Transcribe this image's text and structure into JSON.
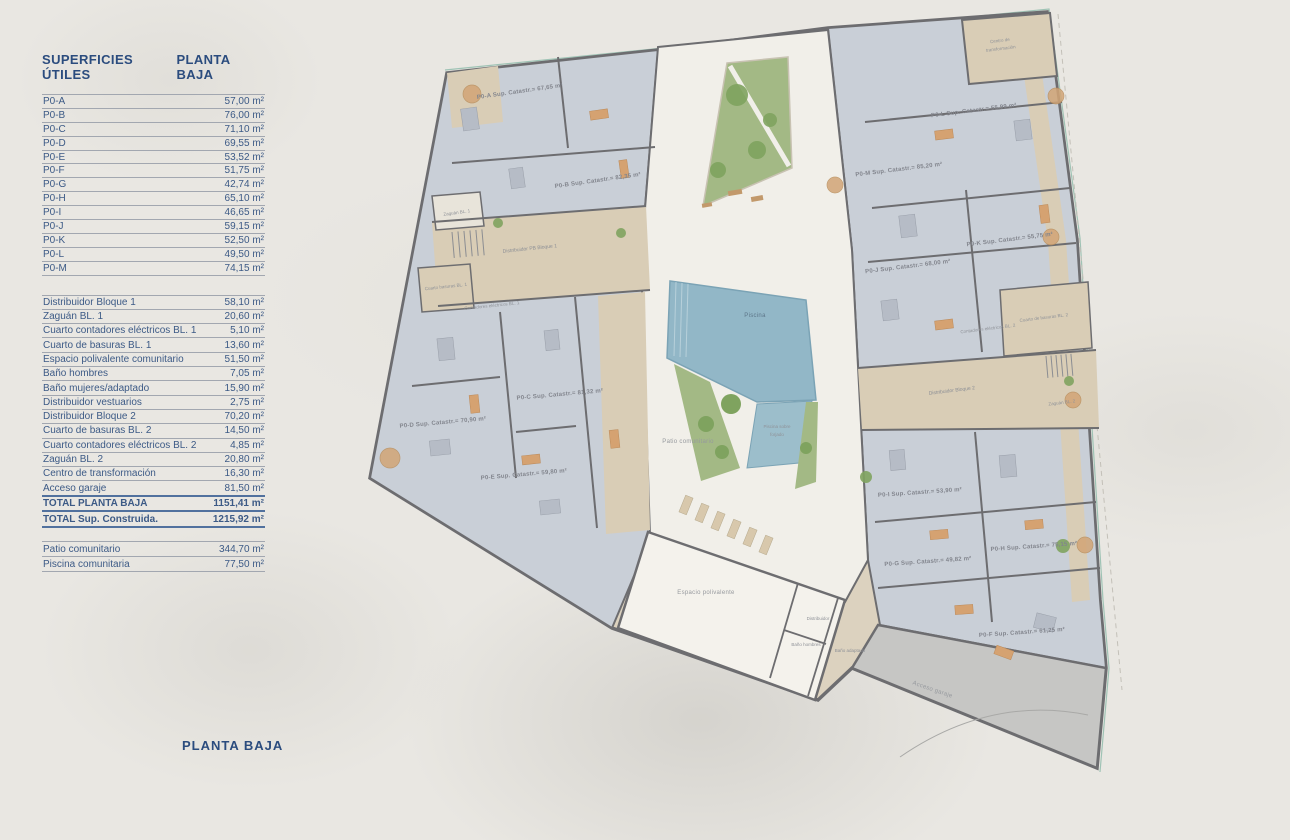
{
  "sidebar": {
    "title_left": "SUPERFICIES ÚTILES",
    "title_right": "PLANTA BAJA",
    "units": [
      {
        "label": "P0-A",
        "value": "57,00 m²"
      },
      {
        "label": "P0-B",
        "value": "76,00 m²"
      },
      {
        "label": "P0-C",
        "value": "71,10 m²"
      },
      {
        "label": "P0-D",
        "value": "69,55 m²"
      },
      {
        "label": "P0-E",
        "value": "53,52 m²"
      },
      {
        "label": "P0-F",
        "value": "51,75 m²"
      },
      {
        "label": "P0-G",
        "value": "42,74 m²"
      },
      {
        "label": "P0-H",
        "value": "65,10 m²"
      },
      {
        "label": "P0-I",
        "value": "46,65 m²"
      },
      {
        "label": "P0-J",
        "value": "59,15 m²"
      },
      {
        "label": "P0-K",
        "value": "52,50 m²"
      },
      {
        "label": "P0-L",
        "value": "49,50 m²"
      },
      {
        "label": "P0-M",
        "value": "74,15 m²"
      }
    ],
    "rooms": [
      {
        "label": "Distribuidor Bloque 1",
        "value": "58,10 m²"
      },
      {
        "label": "Zaguán BL. 1",
        "value": "20,60 m²"
      },
      {
        "label": "Cuarto contadores eléctricos BL. 1",
        "value": "5,10 m²"
      },
      {
        "label": "Cuarto de basuras BL. 1",
        "value": "13,60 m²"
      },
      {
        "label": "Espacio polivalente comunitario",
        "value": "51,50 m²"
      },
      {
        "label": "Baño hombres",
        "value": "7,05 m²"
      },
      {
        "label": "Baño mujeres/adaptado",
        "value": "15,90 m²"
      },
      {
        "label": "Distribuidor vestuarios",
        "value": "2,75 m²"
      },
      {
        "label": "Distribuidor Bloque 2",
        "value": "70,20 m²"
      },
      {
        "label": "Cuarto de basuras BL. 2",
        "value": "14,50 m²"
      },
      {
        "label": "Cuarto contadores eléctricos BL. 2",
        "value": "4,85 m²"
      },
      {
        "label": "Zaguán BL. 2",
        "value": "20,80 m²"
      },
      {
        "label": "Centro de transformación",
        "value": "16,30 m²"
      },
      {
        "label": "Acceso garaje",
        "value": "81,50 m²"
      }
    ],
    "totals": [
      {
        "label": "TOTAL PLANTA BAJA",
        "value": "1151,41 m²"
      },
      {
        "label": "TOTAL Sup. Construida.",
        "value": "1215,92 m²"
      }
    ],
    "outdoor": [
      {
        "label": "Patio comunitario",
        "value": "344,70 m²"
      },
      {
        "label": "Piscina comunitaria",
        "value": "77,50 m²"
      }
    ],
    "footer_label": "PLANTA BAJA"
  },
  "plan": {
    "units": [
      {
        "text": "P0-A Sup. Catastr.= 67,65 m²"
      },
      {
        "text": "P0-B Sup. Catastr.= 82,35 m²"
      },
      {
        "text": "P0-C Sup. Catastr.= 81,32 m²"
      },
      {
        "text": "P0-D Sup. Catastr.= 70,90 m²"
      },
      {
        "text": "P0-E Sup. Catastr.= 59,80 m²"
      },
      {
        "text": "P0-F Sup. Catastr.= 61,25 m²"
      },
      {
        "text": "P0-G Sup. Catastr.= 49,82 m²"
      },
      {
        "text": "P0-H Sup. Catastr.= 75,15 m²"
      },
      {
        "text": "P0-I Sup. Catastr.= 53,90 m²"
      },
      {
        "text": "P0-J Sup. Catastr.= 68,00 m²"
      },
      {
        "text": "P0-K Sup. Catastr.= 55,75 m²"
      },
      {
        "text": "P0-L Sup. Catastr.= 55,99 m²"
      },
      {
        "text": "P0-M Sup. Catastr.= 85,20 m²"
      }
    ],
    "areas": {
      "zaguan1": "Zaguán BL. 1",
      "distribuidor1": "Distribuidor PB Bloque 1",
      "basuras1": "Cuarto basuras BL. 1",
      "contadores1": "Contadores eléctricos BL. 1",
      "piscina": "Piscina",
      "piscina_forjado_1": "Piscina sobre",
      "piscina_forjado_2": "forjado",
      "patio": "Patio comunitario",
      "polivalente": "Espacio polivalente",
      "distribuidor_aseos": "Distribuidor",
      "bano_hombres": "Baño hombres",
      "bano_adaptado": "Baño adaptado",
      "basuras2": "Cuarto de basuras BL. 2",
      "contadores2": "Contadores eléctricos BL. 2",
      "distribuidor2": "Distribuidor Bloque 2",
      "zaguan2": "Zaguán BL. 2",
      "centro_transformacion_1": "Centro de",
      "centro_transformacion_2": "transformación",
      "acceso_garaje": "Acceso garaje"
    },
    "colors": {
      "accent_navy": "#2b4c7e",
      "wall": "#6d6d70",
      "apartment_floor": "#c9cfd7",
      "corridor": "#d9cdb6",
      "patio": "#f1efe9",
      "pool": "#92b7c7",
      "green": "#a3b985",
      "ramp": "#c6c6c4",
      "furniture_tan": "#d5a271"
    }
  }
}
